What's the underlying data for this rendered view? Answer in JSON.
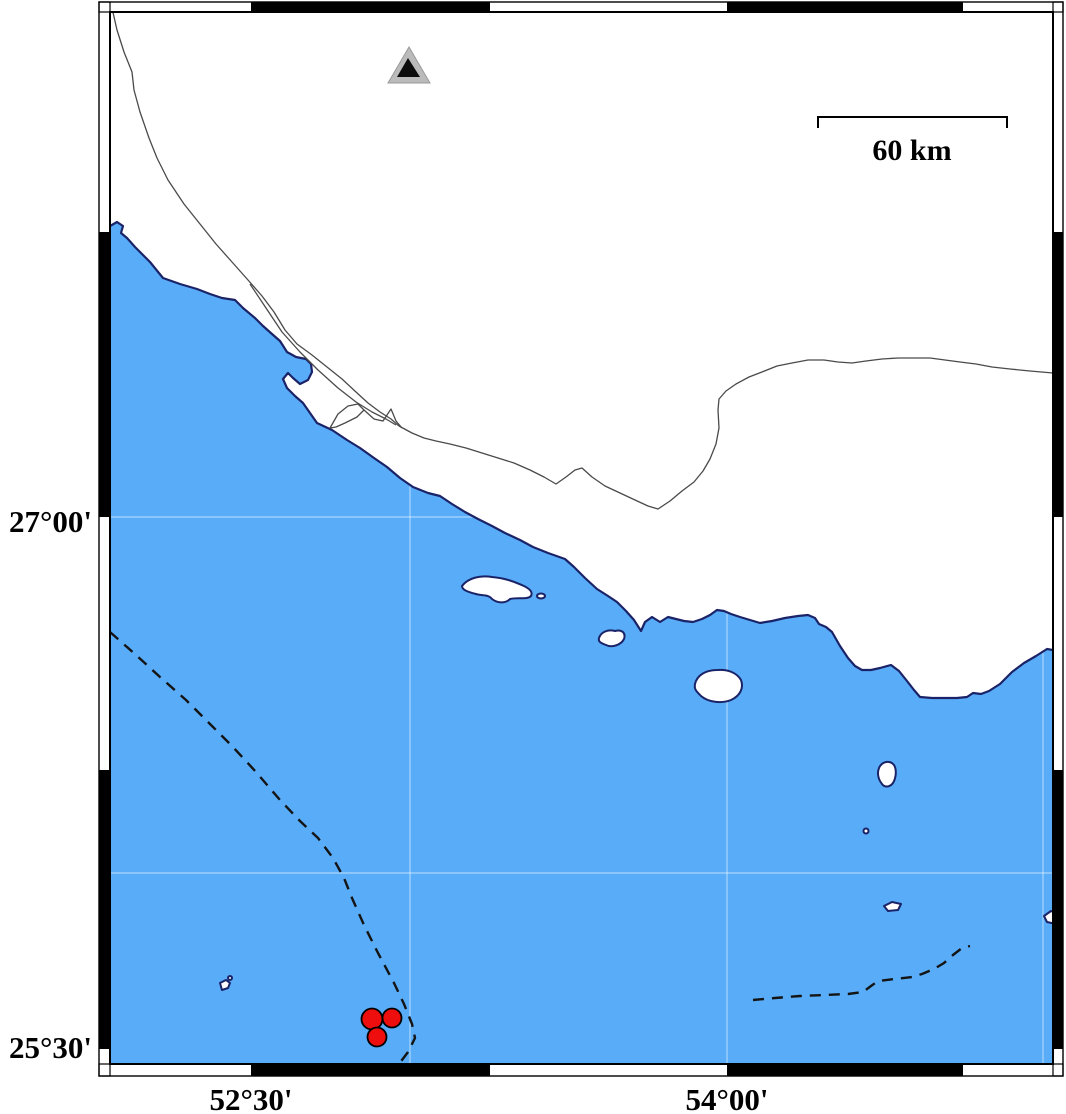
{
  "map": {
    "description": "Coastal map of a gulf region with seismic station and epicenter markers",
    "axis": {
      "left_labels": [
        "27°00'",
        "25°30'"
      ],
      "bottom_labels": [
        "52°30'",
        "54°00'"
      ]
    },
    "scalebar": {
      "label": "60 km"
    },
    "markers": {
      "station_symbol": "triangle",
      "epicenter_symbol": "circle",
      "epicenter_count": 3
    },
    "colors": {
      "sea": "#59ACF7",
      "land": "#FFFFFF",
      "coastline": "#1B2368",
      "epicenter": "#EE0E0E",
      "epicenter_stroke": "#000000",
      "station_outer": "#BBBBBB",
      "station_inner": "#0D0D0D",
      "boundary_dash": "#141414",
      "thin_line": "#4A4A4A",
      "grid": "rgba(255,255,255,0.5)",
      "frame": "#000000"
    }
  }
}
